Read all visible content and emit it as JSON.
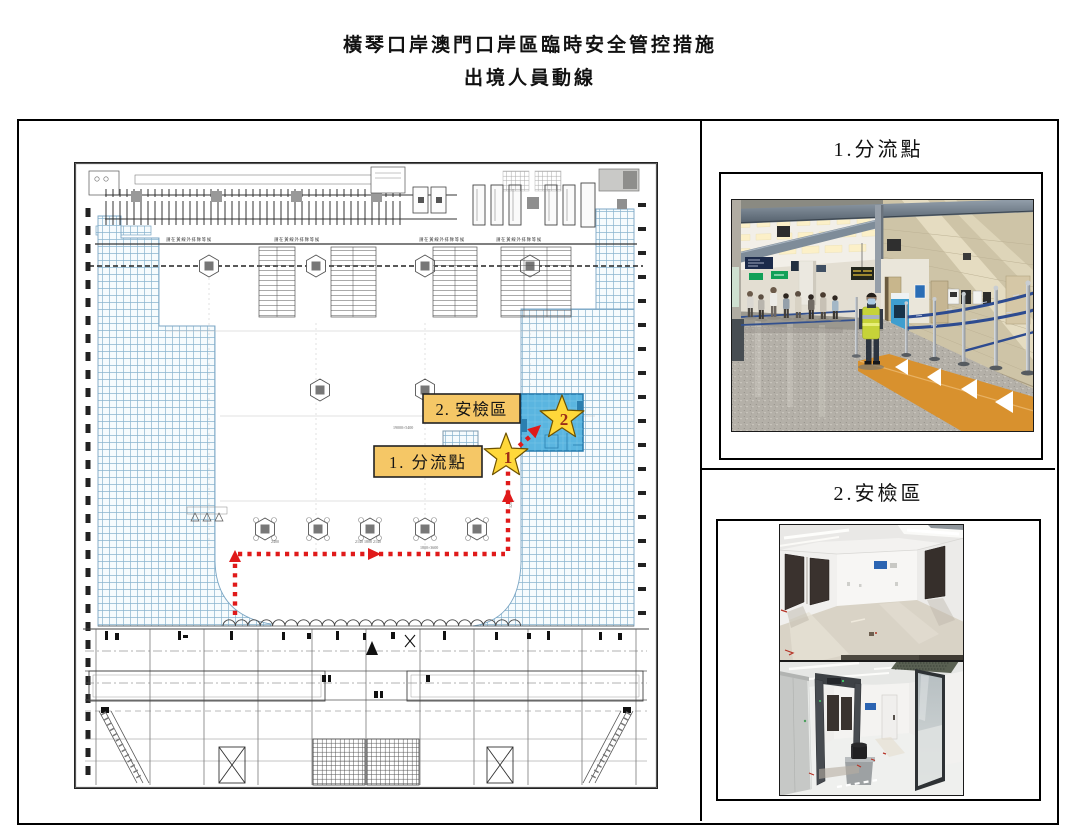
{
  "title": {
    "line1": "橫琴口岸澳門口岸區臨時安全管控措施",
    "line2": "出境人員動線"
  },
  "plan": {
    "queue_sign": "請在黃線外排隊等候",
    "label_security": "2. 安檢區",
    "label_divert": "1. 分流點",
    "star1": "1",
    "star2": "2",
    "dims": [
      "19000×5400",
      "2400",
      "2140 1800 2140",
      "1800×3600",
      "5250",
      "950"
    ]
  },
  "panels": {
    "divert": {
      "label": "1.分流點"
    },
    "security": {
      "label": "2.安檢區"
    }
  },
  "colors": {
    "path_red": "#e01a1a",
    "label_yellow": "#f5c766",
    "star_yellow": "#ffd83a",
    "room_blue": "#5ab5e0",
    "hatch_blue": "#8ab4cf",
    "belt_blue": "#2d4b90",
    "floor_orange": "#d8912e",
    "vest_green": "#c6d338"
  }
}
